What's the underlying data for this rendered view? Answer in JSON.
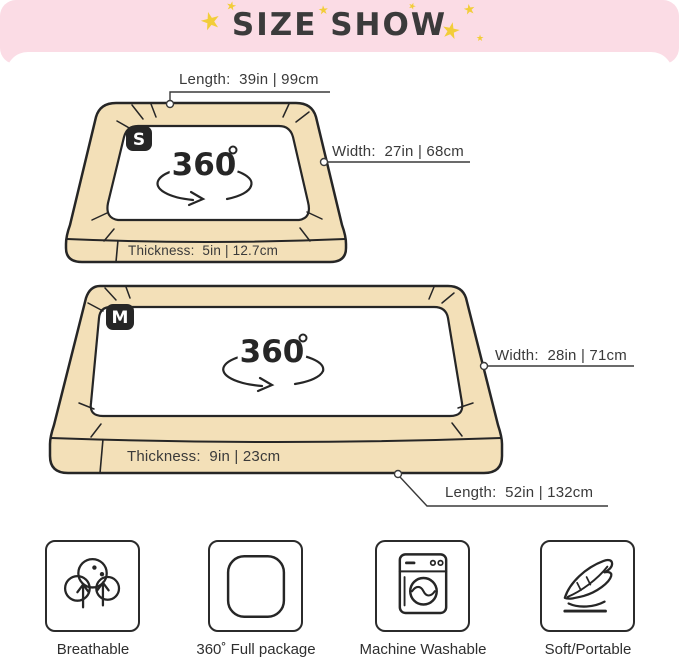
{
  "header": {
    "title": "SIZE SHOW"
  },
  "icons": {
    "star": "★"
  },
  "beds": [
    {
      "badge": "S",
      "rotation": "360",
      "labels": {
        "length": "Length:  39in | 99cm",
        "width": "Width:  27in | 68cm",
        "thickness": "Thickness:  5in | 12.7cm"
      }
    },
    {
      "badge": "M",
      "rotation": "360",
      "labels": {
        "width": "Width:  28in | 71cm",
        "thickness": "Thickness:  9in | 23cm",
        "length": "Length:  52in | 132cm"
      }
    }
  ],
  "features": [
    {
      "label": "Breathable"
    },
    {
      "label": "360˚ Full package"
    },
    {
      "label": "Machine Washable"
    },
    {
      "label": "Soft/Portable"
    }
  ],
  "colors": {
    "header_pink": "#fbdce5",
    "star_yellow": "#f2cd39",
    "bed_tan": "#f3e0b8",
    "outline_dark": "#262626",
    "label_text": "#3a3a3a"
  }
}
